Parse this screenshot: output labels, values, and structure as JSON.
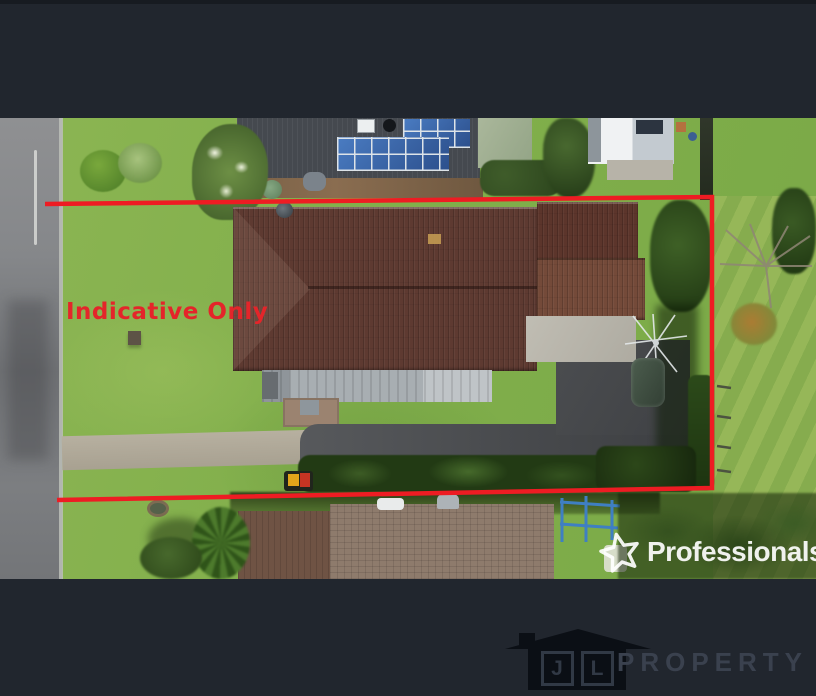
{
  "overlay": {
    "disclaimer": "Indicative Only",
    "boundary_color": "#ee1c23"
  },
  "watermark": {
    "brand": "Professionals",
    "icon": "star-icon",
    "color": "#ffffff"
  },
  "footer": {
    "icon": "house-icon",
    "monogram": {
      "j": "J",
      "l": "L"
    },
    "brand": "PROPERTY",
    "bar_color": "#21262e",
    "text_color": "#3a414e"
  }
}
